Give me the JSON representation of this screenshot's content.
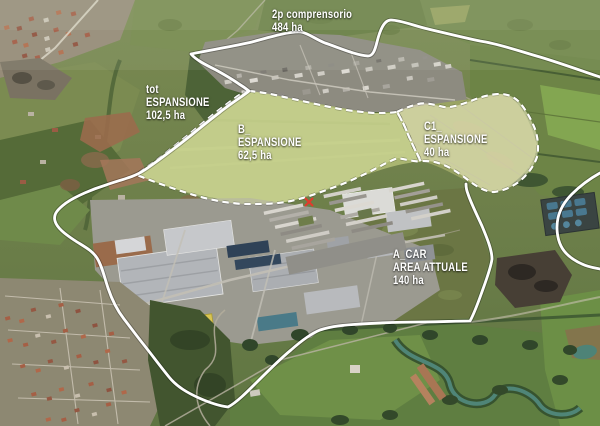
{
  "map": {
    "description": "aerial-oblique-satellite-view-with-planning-zones",
    "annotations": {
      "comprensorio": {
        "lines": [
          "2p comprensorio",
          "484 ha"
        ]
      },
      "tot_espansione": {
        "lines": [
          "tot",
          "ESPANSIONE",
          "102,5 ha"
        ]
      },
      "b_espansione": {
        "lines": [
          "B_",
          "ESPANSIONE",
          "62,5 ha"
        ]
      },
      "c1_espansione": {
        "lines": [
          "C1_",
          "ESPANSIONE",
          "40 ha"
        ]
      },
      "a_car": {
        "lines": [
          "A_CAR",
          "AREA ATTUALE",
          "140 ha"
        ]
      }
    },
    "marker": {
      "glyph": "x",
      "color": "#e33a2c"
    },
    "colors": {
      "boundary_solid": "#ffffff",
      "boundary_dashed": "#ffffff",
      "overlay_b": "rgba(224,233,168,0.45)",
      "overlay_c1": "rgba(242,238,198,0.58)",
      "label_text": "#ffffff"
    }
  }
}
